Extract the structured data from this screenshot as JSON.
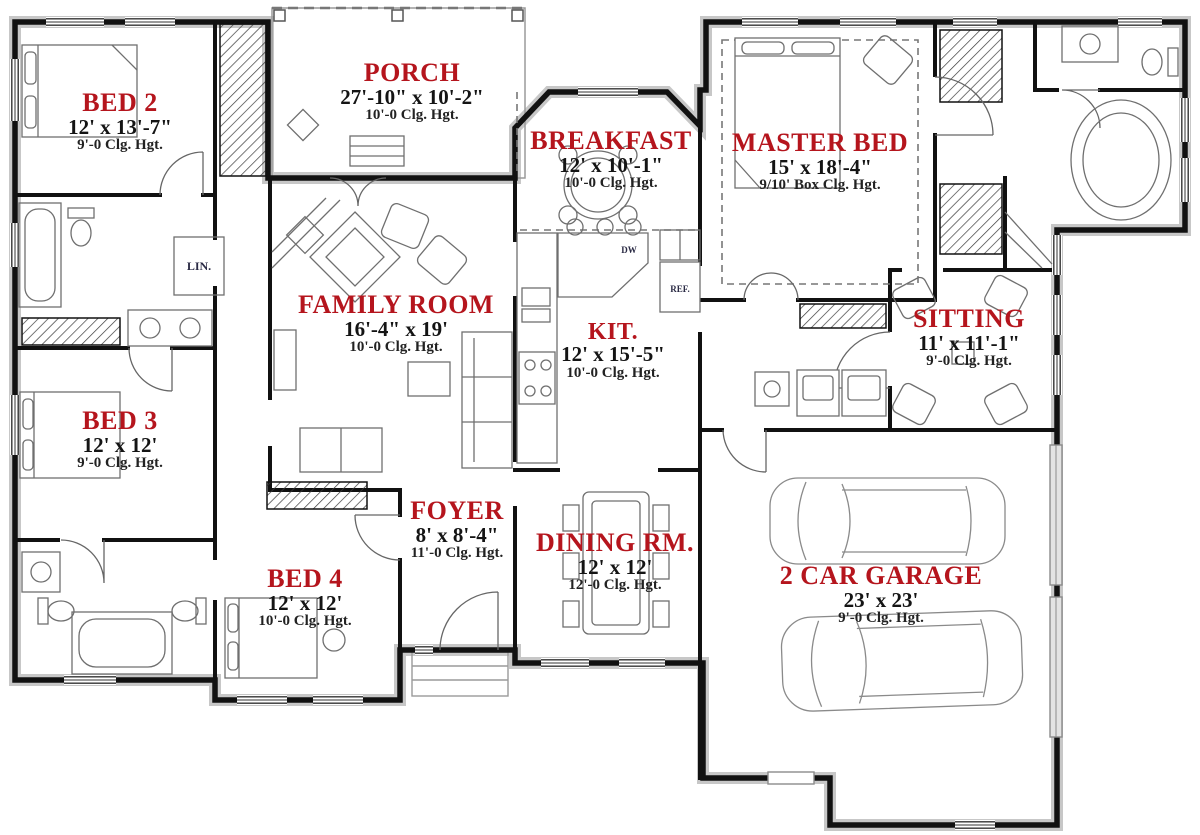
{
  "plan": {
    "type": "single-story house floor plan",
    "accent_color": "#B5151D",
    "wall_color": "#111111",
    "rooms": [
      {
        "id": "bed2",
        "name": "BED 2",
        "dimensions": "12' x 13'-7\"",
        "ceiling": "9'-0 Clg. Hgt."
      },
      {
        "id": "porch",
        "name": "PORCH",
        "dimensions": "27'-10\" x 10'-2\"",
        "ceiling": "10'-0 Clg. Hgt."
      },
      {
        "id": "breakfast",
        "name": "BREAKFAST",
        "dimensions": "12' x 10'-1\"",
        "ceiling": "10'-0 Clg. Hgt."
      },
      {
        "id": "master",
        "name": "MASTER BED",
        "dimensions": "15' x 18'-4\"",
        "ceiling": "9/10' Box Clg. Hgt."
      },
      {
        "id": "family",
        "name": "FAMILY ROOM",
        "dimensions": "16'-4\" x 19'",
        "ceiling": "10'-0 Clg. Hgt."
      },
      {
        "id": "kitchen",
        "name": "KIT.",
        "dimensions": "12' x 15'-5\"",
        "ceiling": "10'-0 Clg. Hgt."
      },
      {
        "id": "sitting",
        "name": "SITTING",
        "dimensions": "11' x 11'-1\"",
        "ceiling": "9'-0 Clg. Hgt."
      },
      {
        "id": "bed3",
        "name": "BED 3",
        "dimensions": "12' x 12'",
        "ceiling": "9'-0 Clg. Hgt."
      },
      {
        "id": "foyer",
        "name": "FOYER",
        "dimensions": "8' x 8'-4\"",
        "ceiling": "11'-0 Clg. Hgt."
      },
      {
        "id": "dining",
        "name": "DINING RM.",
        "dimensions": "12' x 12'",
        "ceiling": "12'-0 Clg. Hgt."
      },
      {
        "id": "bed4",
        "name": "BED 4",
        "dimensions": "12' x 12'",
        "ceiling": "10'-0 Clg. Hgt."
      },
      {
        "id": "garage",
        "name": "2 CAR GARAGE",
        "dimensions": "23' x 23'",
        "ceiling": "9'-0 Clg. Hgt."
      }
    ],
    "fixtures": {
      "linen_closet": "LIN.",
      "dishwasher": "DW",
      "refrigerator": "REF."
    }
  }
}
